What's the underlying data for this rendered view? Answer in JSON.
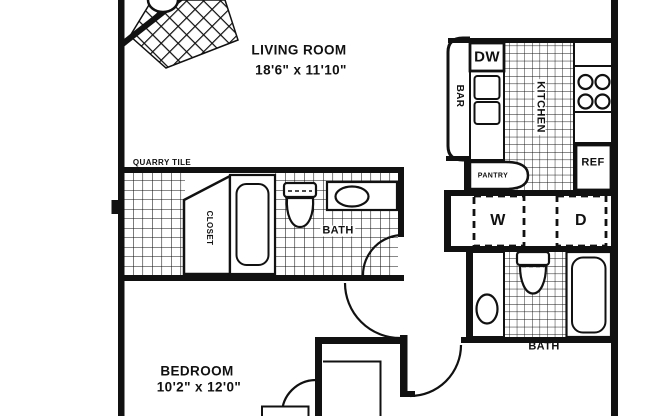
{
  "labels": {
    "quarry_tile": "QUARRY TILE",
    "living_room_name": "LIVING ROOM",
    "living_room_dims": "18'6\" x 11'10\"",
    "bedroom_name": "BEDROOM",
    "bedroom_dims": "10'2\" x 12'0\"",
    "kitchen": "KITCHEN",
    "bar": "BAR",
    "dishwasher": "DW",
    "refrigerator": "REF",
    "pantry": "PANTRY",
    "washer": "W",
    "dryer": "D",
    "hall_bath": "BATH",
    "master_bath": "BATH",
    "closet": "CLOSET"
  },
  "colors": {
    "line": "#111111",
    "background": "#ffffff"
  }
}
